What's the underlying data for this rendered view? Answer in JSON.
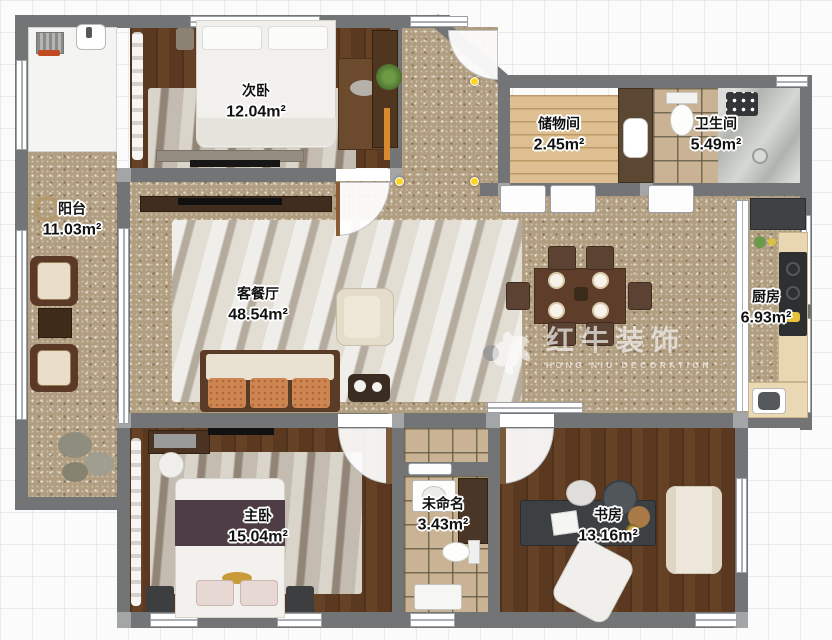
{
  "watermark": {
    "brand": "红牛装饰",
    "subtitle": "HONG NIU DECORATION",
    "logo_icon": "bull-icon"
  },
  "rooms": [
    {
      "name": "次卧",
      "area": "12.04m²"
    },
    {
      "name": "储物间",
      "area": "2.45m²"
    },
    {
      "name": "卫生间",
      "area": "5.49m²"
    },
    {
      "name": "阳台",
      "area": "11.03m²"
    },
    {
      "name": "客餐厅",
      "area": "48.54m²"
    },
    {
      "name": "厨房",
      "area": "6.93m²"
    },
    {
      "name": "主卧",
      "area": "15.04m²"
    },
    {
      "name": "未命名",
      "area": "3.43m²"
    },
    {
      "name": "书房",
      "area": "13.16m²"
    }
  ]
}
